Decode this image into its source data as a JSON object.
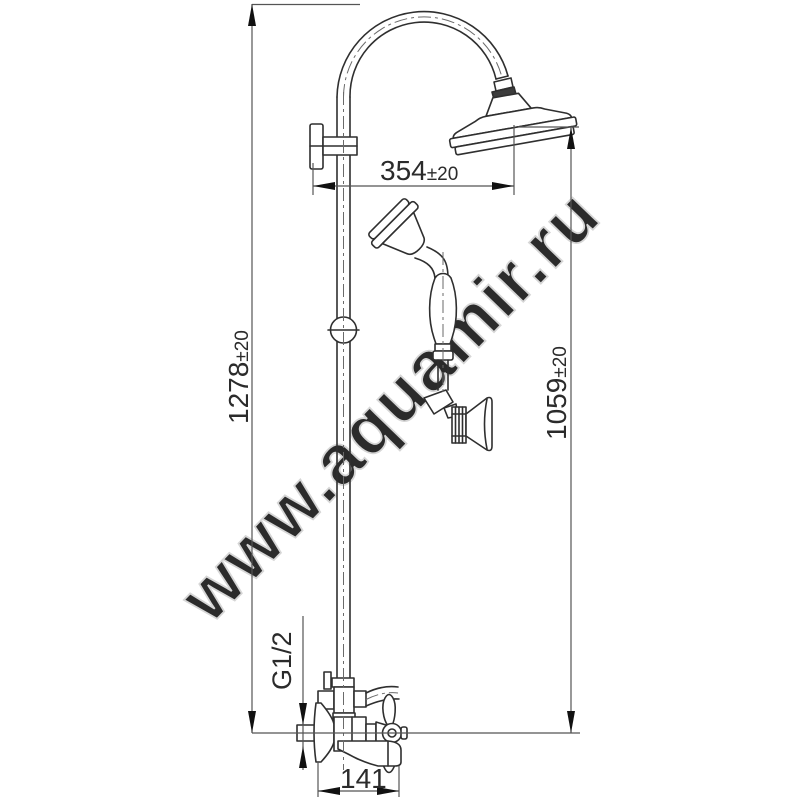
{
  "watermark": "www.aquamir.ru",
  "dimensions": {
    "total_height": {
      "value": "1278",
      "tolerance": "±20"
    },
    "arm_reach": {
      "value": "354",
      "tolerance": "±20"
    },
    "shower_height": {
      "value": "1059",
      "tolerance": "±20"
    },
    "spout_length": {
      "value": "141"
    },
    "connection_thread": {
      "value": "G1/2"
    }
  },
  "colors": {
    "background": "#ffffff",
    "drawing_line": "#2f2f2f",
    "dimension_line": "#555555",
    "arrow": "#111111",
    "centerline": "#6a6a6a",
    "watermark_fill": "#f2f2f2",
    "watermark_stroke": "#d6d6d6",
    "dark_ring": "#3c3c3c"
  }
}
